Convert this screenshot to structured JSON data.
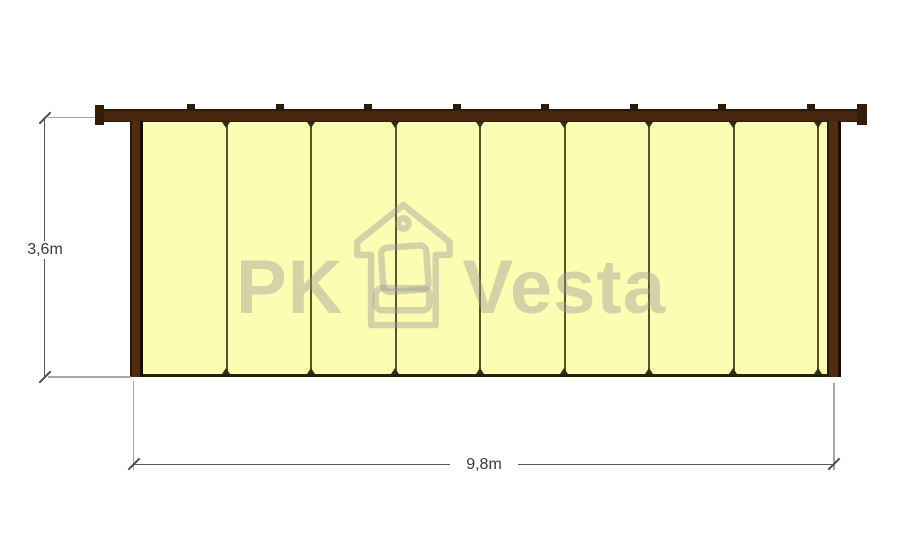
{
  "drawing": {
    "type": "wall-elevation-technical-drawing",
    "height_dimension": {
      "label": "3,6m"
    },
    "width_dimension": {
      "label": "9,8m"
    },
    "panel_count": 8,
    "batten_count": 8,
    "batten_start_px": 85,
    "batten_spacing_px": 88.5,
    "watermark": {
      "left_text": "PK",
      "right_text": "Vesta",
      "icon": "house-icon"
    },
    "colors": {
      "panel_fill": "#FCFCB2",
      "frame_dark": "#46260E",
      "divider": "#55552B",
      "baseline": "#23230C",
      "dimension_line": "#5A5A5A",
      "extension_line": "#A8A8A8",
      "label_text": "#3A3A3A",
      "watermark_gray": "rgba(150,150,150,0.40)"
    }
  }
}
